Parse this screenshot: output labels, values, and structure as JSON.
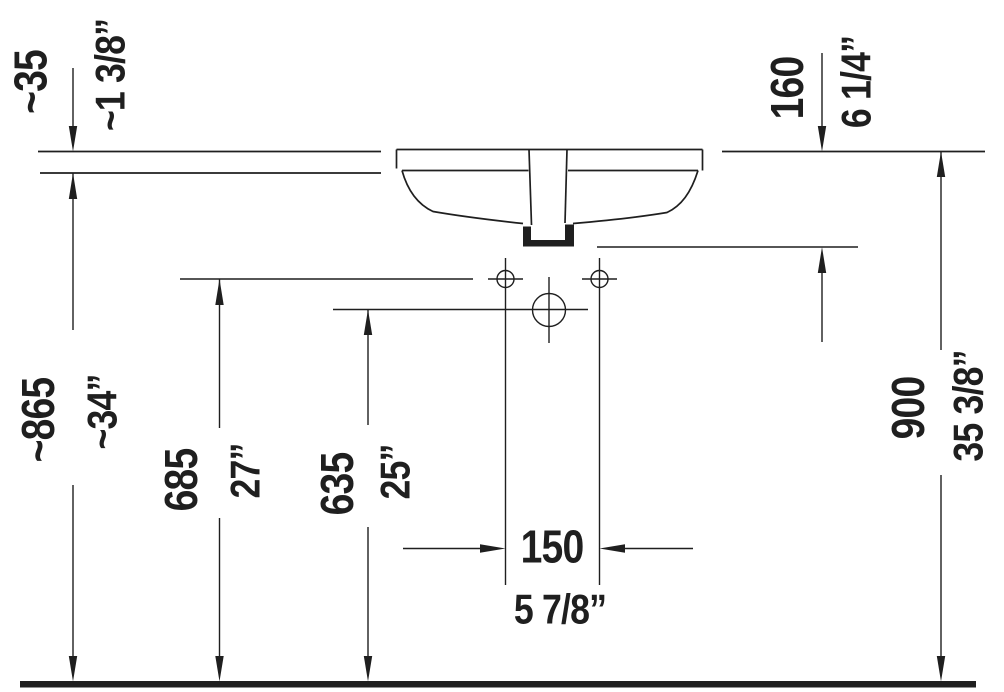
{
  "drawing": {
    "background": "#ffffff",
    "line_color": "#1f1f1f",
    "kind": "washbasin installation dimension drawing",
    "units": {
      "primary": "mm",
      "secondary": "inch"
    }
  },
  "dimensions": {
    "counter_thickness": {
      "mm": "~35",
      "inch": "~1 3/8”"
    },
    "rim_to_outlet": {
      "mm": "160",
      "inch": "6 1/4”"
    },
    "floor_to_underside": {
      "mm": "~865",
      "inch": "~34”"
    },
    "floor_to_fixing_holes": {
      "mm": "685",
      "inch": "27”"
    },
    "floor_to_outlet_center": {
      "mm": "635",
      "inch": "25”"
    },
    "fixing_hole_spacing": {
      "mm": "150",
      "inch": "5 7/8”"
    },
    "floor_to_rim": {
      "mm": "900",
      "inch": "35 3/8”"
    }
  }
}
